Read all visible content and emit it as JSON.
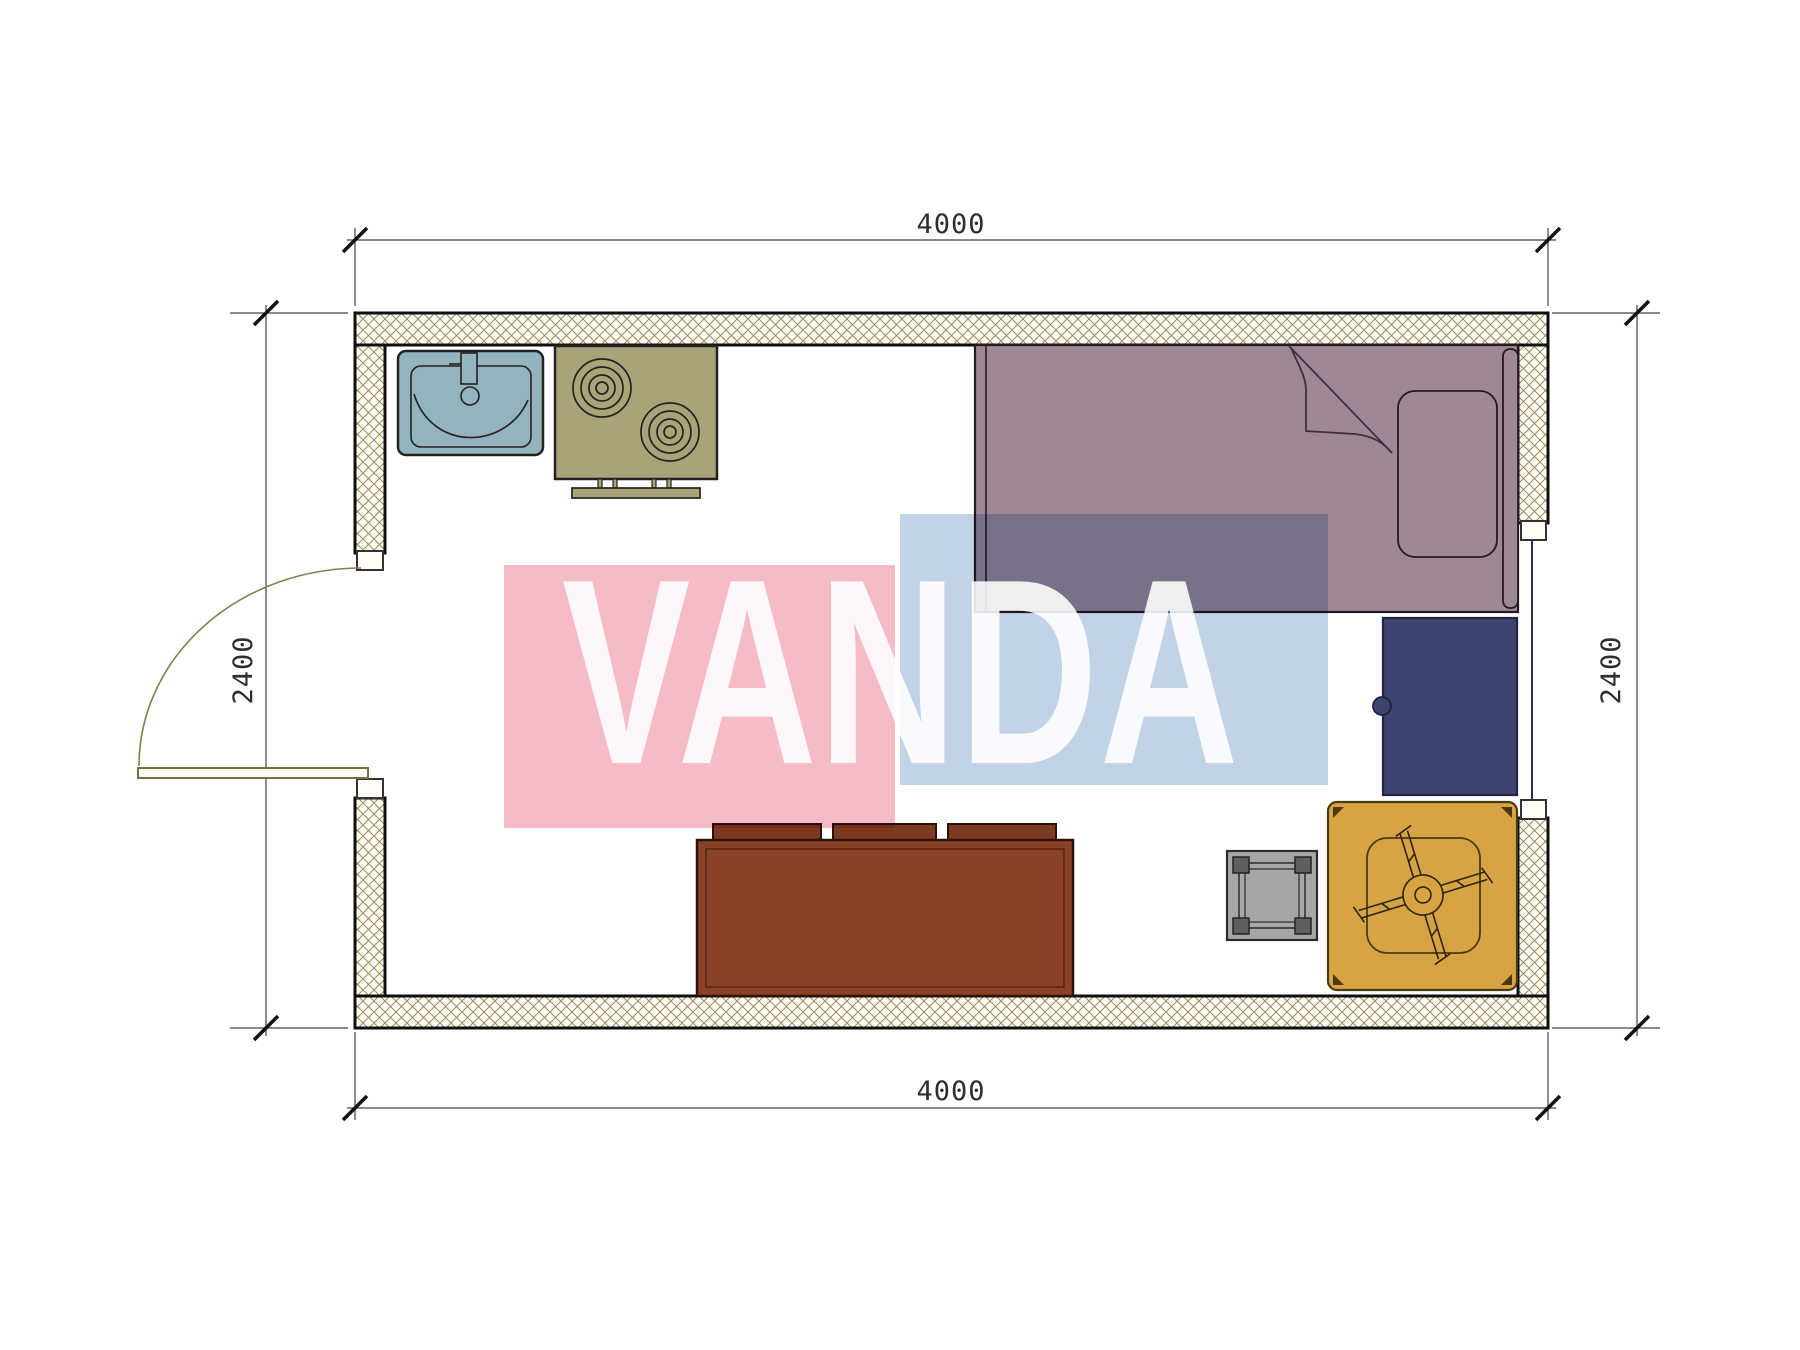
{
  "dimensions": {
    "top": "4000",
    "bottom": "4000",
    "left": "2400",
    "right": "2400"
  },
  "watermark": {
    "text": "VANDA",
    "pink_color": "#f5bcc8",
    "blue_color": "#c2d3e8",
    "text_color": "rgba(255,255,255,0.88)"
  },
  "colors": {
    "wall_hatch": "#9b8b57",
    "sink": "#93b3bd",
    "stove": "#a9a478",
    "bed": "#9e8896",
    "wardrobe": "#3e4470",
    "armchair": "#d6a443",
    "stool": "#a6a6a6",
    "table": "#8a4127"
  },
  "furniture": [
    {
      "name": "sink"
    },
    {
      "name": "stove"
    },
    {
      "name": "bed"
    },
    {
      "name": "pillow"
    },
    {
      "name": "wardrobe"
    },
    {
      "name": "armchair-with-fan-base"
    },
    {
      "name": "stool"
    },
    {
      "name": "dining-table-with-chairs"
    },
    {
      "name": "door"
    },
    {
      "name": "window"
    }
  ]
}
